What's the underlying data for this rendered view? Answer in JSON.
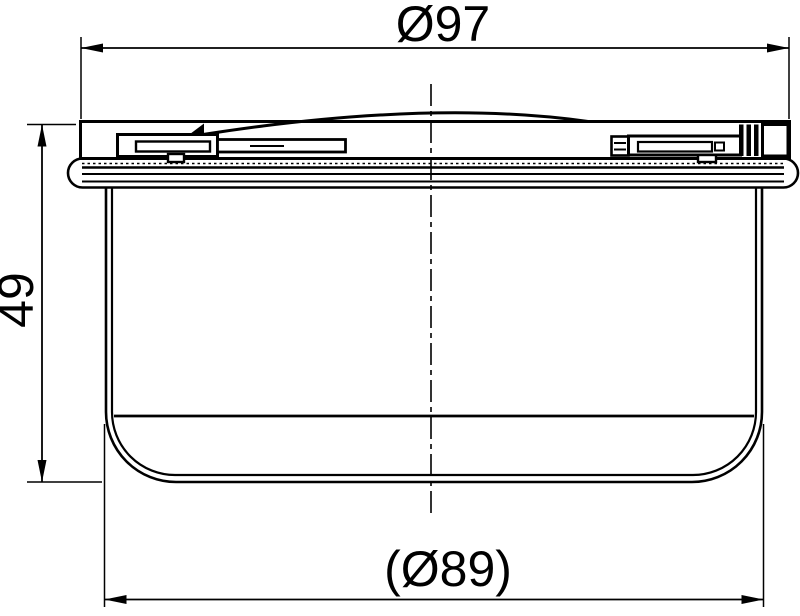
{
  "drawing": {
    "kind": "technical-drawing",
    "view": "side cross-section of round drain cup with lid and sealing flange",
    "background_color": "#ffffff",
    "line_color": "#000000",
    "dimensions": {
      "top_diameter": {
        "label": "Ø97"
      },
      "height": {
        "label": "49"
      },
      "bottom_diameter": {
        "label": "(Ø89)"
      }
    }
  }
}
